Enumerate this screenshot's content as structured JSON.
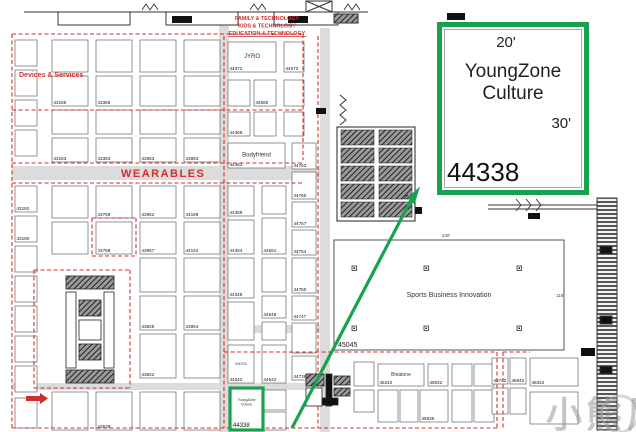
{
  "page": {
    "width": 636,
    "height": 432
  },
  "colors": {
    "green": "#18a24d",
    "red": "#d22e2e",
    "corridor": "#dcdcdc"
  },
  "callout": {
    "dim_top": "20'",
    "name_line1": "YoungZone",
    "name_line2": "Culture",
    "dim_right": "30'",
    "booth_number": "44338"
  },
  "highlight_booth": {
    "name_line1": "YoungZone",
    "name_line2": "Culture",
    "number": "44338"
  },
  "labels": {
    "family": "FAMILY & TECHNOLOGY",
    "kids": "KIDS & TECHNOLOGY",
    "education": "EDUCATION & TECHNOLOGY",
    "devices": "Devices & Services",
    "wearables": "WEARABLES"
  },
  "open_area": {
    "name": "Sports Business Innovation",
    "number": "45045",
    "dim_top": "230'",
    "dim_right": "118'"
  },
  "watermark": {
    "text": "小熊尼奥"
  },
  "map": {
    "corridors": [
      [
        219,
        20,
        10,
        412
      ],
      [
        320,
        28,
        10,
        404
      ],
      [
        12,
        166,
        318,
        14
      ],
      [
        12,
        383,
        296,
        7
      ],
      [
        222,
        325,
        98,
        8
      ]
    ],
    "dashes": [
      [
        12,
        34,
        303,
        34
      ],
      [
        12,
        34,
        12,
        430
      ],
      [
        12,
        428,
        497,
        428
      ],
      [
        12,
        110,
        303,
        110
      ],
      [
        12,
        163,
        303,
        163
      ],
      [
        12,
        183,
        303,
        183
      ],
      [
        224,
        36,
        224,
        428
      ],
      [
        318,
        36,
        318,
        428
      ],
      [
        303,
        34,
        303,
        160
      ],
      [
        34,
        270,
        130,
        270
      ],
      [
        34,
        388,
        130,
        388
      ],
      [
        34,
        270,
        34,
        388
      ],
      [
        130,
        270,
        130,
        388
      ],
      [
        92,
        218,
        136,
        218
      ],
      [
        92,
        256,
        136,
        256
      ],
      [
        92,
        218,
        92,
        256
      ],
      [
        136,
        218,
        136,
        256
      ],
      [
        224,
        352,
        497,
        352
      ],
      [
        497,
        352,
        497,
        428
      ],
      [
        503,
        352,
        503,
        430
      ],
      [
        503,
        352,
        530,
        352
      ]
    ],
    "posts": [
      [
        352,
        266
      ],
      [
        424,
        266
      ],
      [
        517,
        266
      ],
      [
        352,
        326
      ],
      [
        424,
        326
      ],
      [
        517,
        326
      ]
    ],
    "booths": [
      [
        15,
        40,
        22,
        26,
        "",
        ""
      ],
      [
        15,
        70,
        22,
        26,
        "",
        ""
      ],
      [
        15,
        100,
        22,
        26,
        "",
        ""
      ],
      [
        15,
        130,
        22,
        26,
        "",
        ""
      ],
      [
        15,
        186,
        22,
        26,
        "43192",
        ""
      ],
      [
        15,
        216,
        22,
        26,
        "43190",
        ""
      ],
      [
        15,
        246,
        22,
        26,
        "",
        ""
      ],
      [
        15,
        276,
        22,
        26,
        "",
        ""
      ],
      [
        15,
        306,
        22,
        26,
        "",
        ""
      ],
      [
        15,
        336,
        22,
        26,
        "",
        ""
      ],
      [
        15,
        366,
        22,
        26,
        "",
        ""
      ],
      [
        15,
        398,
        22,
        30,
        "",
        ""
      ],
      [
        52,
        40,
        36,
        32,
        "",
        ""
      ],
      [
        96,
        40,
        36,
        32,
        "",
        ""
      ],
      [
        140,
        40,
        36,
        32,
        "",
        ""
      ],
      [
        184,
        40,
        36,
        32,
        "",
        ""
      ],
      [
        52,
        76,
        36,
        30,
        "43166",
        ""
      ],
      [
        96,
        76,
        36,
        30,
        "43366",
        ""
      ],
      [
        140,
        76,
        36,
        30,
        "",
        ""
      ],
      [
        184,
        76,
        36,
        30,
        "",
        ""
      ],
      [
        52,
        110,
        36,
        24,
        "",
        ""
      ],
      [
        96,
        110,
        36,
        24,
        "",
        ""
      ],
      [
        140,
        110,
        36,
        24,
        "",
        ""
      ],
      [
        184,
        110,
        36,
        24,
        "",
        ""
      ],
      [
        52,
        138,
        36,
        24,
        "43163",
        ""
      ],
      [
        96,
        138,
        36,
        24,
        "43363",
        ""
      ],
      [
        140,
        138,
        36,
        24,
        "43563",
        ""
      ],
      [
        184,
        138,
        36,
        24,
        "43963",
        ""
      ],
      [
        52,
        186,
        36,
        32,
        "",
        ""
      ],
      [
        96,
        186,
        36,
        32,
        "43759",
        ""
      ],
      [
        140,
        186,
        36,
        32,
        "43962",
        ""
      ],
      [
        184,
        186,
        36,
        32,
        "44159",
        ""
      ],
      [
        52,
        222,
        36,
        32,
        "",
        ""
      ],
      [
        96,
        222,
        36,
        32,
        "43758",
        ""
      ],
      [
        140,
        222,
        36,
        32,
        "43957",
        ""
      ],
      [
        184,
        222,
        36,
        32,
        "44154",
        ""
      ],
      [
        140,
        258,
        36,
        34,
        "",
        ""
      ],
      [
        184,
        258,
        36,
        34,
        "",
        ""
      ],
      [
        140,
        296,
        36,
        34,
        "43845",
        ""
      ],
      [
        184,
        296,
        36,
        34,
        "43954",
        ""
      ],
      [
        140,
        334,
        36,
        44,
        "43842",
        ""
      ],
      [
        184,
        334,
        36,
        44,
        "",
        ""
      ],
      [
        52,
        392,
        36,
        38,
        "",
        ""
      ],
      [
        96,
        392,
        36,
        38,
        "43639",
        ""
      ],
      [
        140,
        392,
        36,
        38,
        "",
        ""
      ],
      [
        184,
        392,
        36,
        38,
        "",
        ""
      ],
      [
        228,
        42,
        48,
        30,
        "44372",
        "JYRO",
        6
      ],
      [
        284,
        42,
        20,
        30,
        "44572",
        ""
      ],
      [
        228,
        80,
        22,
        26,
        "",
        ""
      ],
      [
        254,
        80,
        22,
        26,
        "44580",
        ""
      ],
      [
        284,
        80,
        20,
        26,
        "",
        ""
      ],
      [
        228,
        112,
        22,
        24,
        "44368",
        ""
      ],
      [
        254,
        112,
        22,
        24,
        "",
        ""
      ],
      [
        284,
        112,
        20,
        24,
        "",
        ""
      ],
      [
        228,
        143,
        57,
        25,
        "44363",
        "Bodyfriend",
        6
      ],
      [
        228,
        186,
        26,
        30,
        "44359",
        ""
      ],
      [
        228,
        220,
        26,
        34,
        "44354",
        ""
      ],
      [
        228,
        258,
        26,
        40,
        "44348",
        ""
      ],
      [
        228,
        302,
        26,
        38,
        "",
        ""
      ],
      [
        228,
        345,
        26,
        38,
        "44342",
        "MOTA",
        4
      ],
      [
        262,
        186,
        24,
        28,
        "",
        ""
      ],
      [
        262,
        218,
        24,
        36,
        "44551",
        ""
      ],
      [
        262,
        258,
        24,
        34,
        "",
        ""
      ],
      [
        262,
        296,
        24,
        22,
        "44548",
        ""
      ],
      [
        262,
        322,
        24,
        18,
        "",
        ""
      ],
      [
        262,
        345,
        24,
        38,
        "44542",
        ""
      ],
      [
        262,
        390,
        24,
        20,
        "",
        ""
      ],
      [
        262,
        412,
        24,
        18,
        "",
        ""
      ],
      [
        292,
        143,
        24,
        26,
        "44763",
        ""
      ],
      [
        292,
        172,
        24,
        27,
        "44760",
        ""
      ],
      [
        292,
        202,
        24,
        25,
        "44757",
        ""
      ],
      [
        292,
        230,
        24,
        25,
        "44754",
        ""
      ],
      [
        292,
        258,
        24,
        35,
        "44750",
        ""
      ],
      [
        292,
        296,
        24,
        24,
        "44747",
        ""
      ],
      [
        292,
        323,
        24,
        30,
        "",
        ""
      ],
      [
        292,
        356,
        24,
        24,
        "44738",
        ""
      ],
      [
        354,
        362,
        20,
        24,
        "",
        ""
      ],
      [
        354,
        390,
        20,
        22,
        "",
        ""
      ],
      [
        378,
        364,
        46,
        22,
        "45242",
        "Binatone",
        5
      ],
      [
        428,
        364,
        20,
        22,
        "45042",
        ""
      ],
      [
        378,
        390,
        20,
        32,
        "",
        ""
      ],
      [
        400,
        390,
        18,
        32,
        "",
        ""
      ],
      [
        420,
        390,
        28,
        32,
        "45536",
        ""
      ],
      [
        452,
        364,
        20,
        22,
        "",
        ""
      ],
      [
        474,
        364,
        20,
        22,
        "",
        ""
      ],
      [
        452,
        390,
        20,
        32,
        "",
        ""
      ],
      [
        474,
        390,
        20,
        32,
        "",
        ""
      ],
      [
        492,
        358,
        16,
        26,
        "45742",
        ""
      ],
      [
        510,
        358,
        16,
        26,
        "45842",
        ""
      ],
      [
        530,
        358,
        48,
        28,
        "46342",
        ""
      ],
      [
        492,
        388,
        16,
        26,
        "",
        ""
      ],
      [
        510,
        388,
        16,
        26,
        "",
        ""
      ],
      [
        530,
        392,
        48,
        32,
        "",
        ""
      ]
    ]
  }
}
